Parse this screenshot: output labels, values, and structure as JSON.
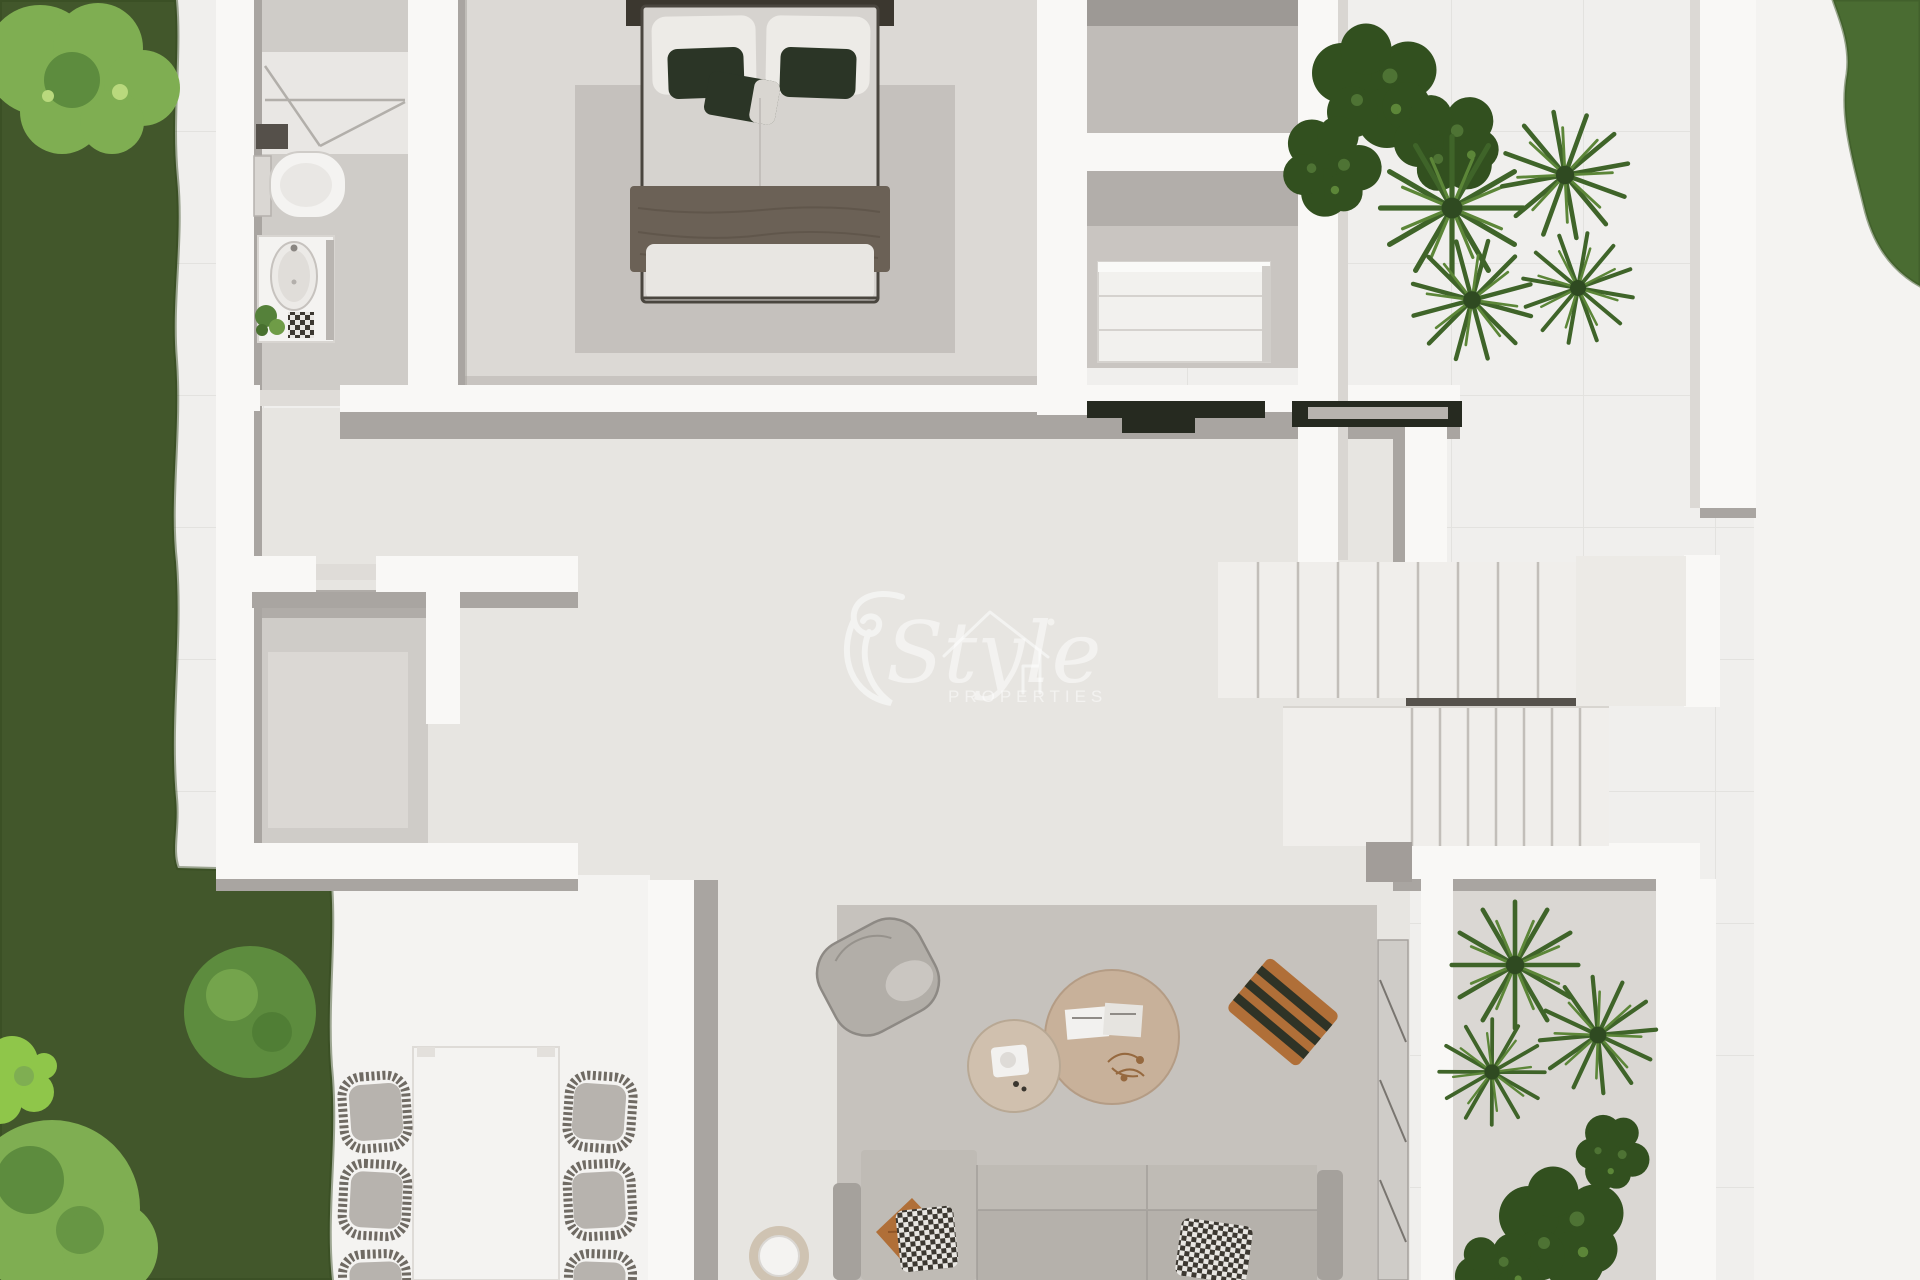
{
  "scene": {
    "description": "Top-down 3D render of a villa ground-floor plan with garden, terraces and staircase",
    "view": "bird's-eye / plan view",
    "rendered_text_visible": [
      "Style",
      "PROPERTIES"
    ]
  },
  "watermark": {
    "script_text": "Style",
    "sub_text": "PROPERTIES",
    "icon": "house-outline-icon",
    "color": "#ffffff",
    "opacity": 0.52
  },
  "palette": {
    "terrace": "#f0efed",
    "terraceBright": "#f4f3f1",
    "floor": "#e7e5e1",
    "roomFloor": "#cfccc8",
    "wallTop": "#f9f8f6",
    "wallSide": "#a9a5a1",
    "wallSideDark": "#8f8b87",
    "grass": "#42572b",
    "bushLight": "#7fae52",
    "bushMid": "#5d8c3e",
    "bushBright": "#8fc64a",
    "hedge": "#4a6c32",
    "rugLiving": "#c6c2bd",
    "rugBedroom": "#c5c1bd",
    "stairTread": "#f0eeeb",
    "stairLanding": "#eceae6",
    "darkCounter": "#262a20",
    "sofa": "#b5b1ab",
    "sofaCushion": "#bfbbb5",
    "sofaArm": "#a5a19c",
    "whiteFurniture": "#f4f3f1",
    "tableTan": "#c8b19a",
    "tableTanLight": "#d0c0ae",
    "woodOrange": "#b06f38",
    "bedHeadboard": "#3b372f",
    "bedDuvet": "#d6d3cf",
    "bedThrow": "#6b6156",
    "pillowWhite": "#edebe7",
    "pillowGreen": "#2b3526",
    "plantDark": "#32501f",
    "plantMid": "#3f6429",
    "plantLight": "#5c8638",
    "chairCushion": "#b7b3ae",
    "wmColor": "#ffffff",
    "wmOpacity": 0.52
  },
  "rooms": [
    {
      "name": "garden-lawn"
    },
    {
      "name": "bathroom"
    },
    {
      "name": "master-bedroom"
    },
    {
      "name": "dressing-room"
    },
    {
      "name": "storage-room"
    },
    {
      "name": "hallway-living-area"
    },
    {
      "name": "staircase"
    },
    {
      "name": "dining-terrace"
    },
    {
      "name": "right-terrace"
    },
    {
      "name": "planter-bed"
    }
  ],
  "furniture_icons": [
    {
      "name": "shower-icon"
    },
    {
      "name": "toilet-icon"
    },
    {
      "name": "vanity-sink-icon"
    },
    {
      "name": "double-bed-icon"
    },
    {
      "name": "dresser-icon"
    },
    {
      "name": "console-counter-icon"
    },
    {
      "name": "stairs-icon"
    },
    {
      "name": "sofa-icon"
    },
    {
      "name": "pouf-armchair-icon"
    },
    {
      "name": "coffee-table-icon"
    },
    {
      "name": "wood-bench-icon"
    },
    {
      "name": "side-stool-icon"
    },
    {
      "name": "dining-table-icon"
    },
    {
      "name": "wicker-chair-icon"
    },
    {
      "name": "fiddle-leaf-plant-icon"
    },
    {
      "name": "palm-plant-icon"
    },
    {
      "name": "bush-icon"
    }
  ]
}
